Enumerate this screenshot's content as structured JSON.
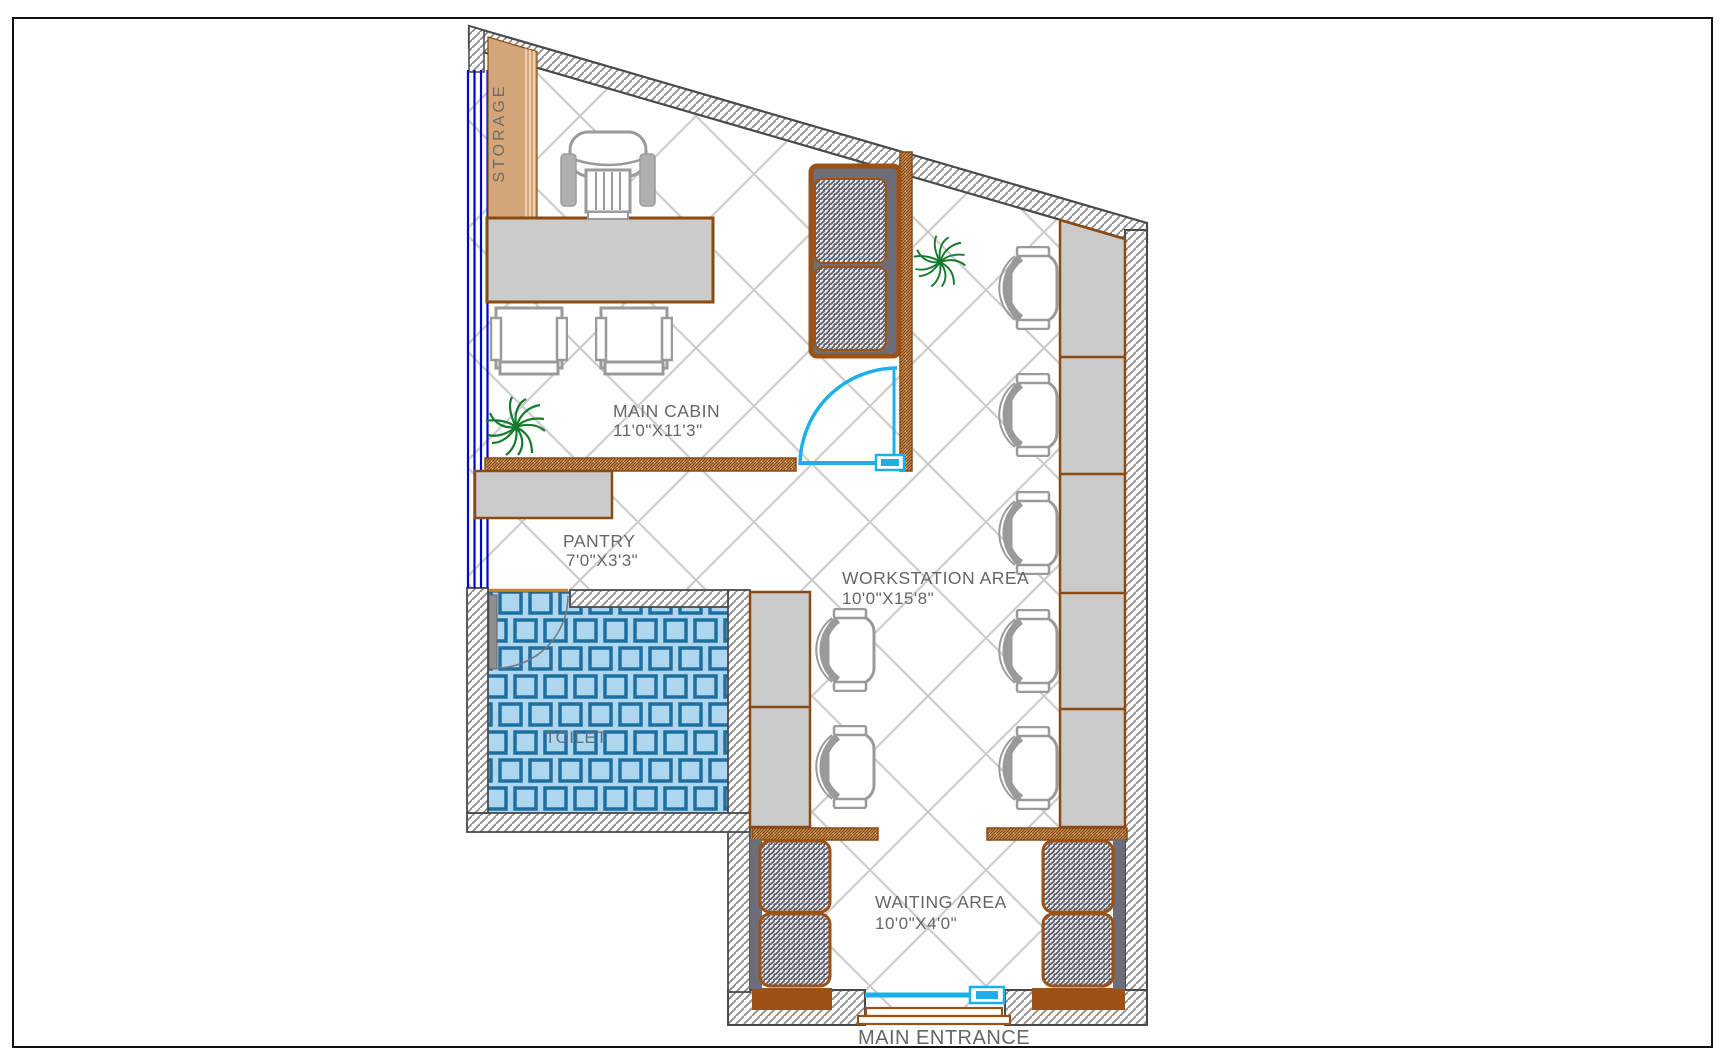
{
  "rooms": {
    "storage": {
      "label": "STORAGE"
    },
    "main_cabin": {
      "label": "MAIN CABIN",
      "dims": "11'0\"X11'3\""
    },
    "pantry": {
      "label": "PANTRY",
      "dims": "7'0\"X3'3\""
    },
    "toilet": {
      "label": "TOILET"
    },
    "workstation": {
      "label": "WORKSTATION AREA",
      "dims": "10'0\"X15'8\""
    },
    "waiting": {
      "label": "WAITING AREA",
      "dims": "10'0\"X4'0\""
    },
    "entrance": {
      "label": "MAIN ENTRANCE"
    }
  },
  "furniture_counts": {
    "workstation_desk_segments_right": 5,
    "workstation_desk_segments_left": 2,
    "workstation_chairs_right": 5,
    "workstation_chairs_left": 2,
    "guest_chairs_main_cabin": 2,
    "sofas": 3,
    "plants": 2
  },
  "colors": {
    "wall_outline": "#4a4a4a",
    "wall_hatch": "#8c8c8c",
    "partition_brown": "#8a4a12",
    "partition_tan": "#e2b98a",
    "solid_brown": "#9c5214",
    "desk_gray": "#cbcbcb",
    "sofa_texture_dark": "#5a5a64",
    "sofa_back_gray": "#6e6e7a",
    "door_cyan": "#1cb0e8",
    "window_blue": "#0008cc",
    "tile_fill": "#aed7ef",
    "tile_line": "#1e6f9f",
    "floor_grid": "#cccccc",
    "label_gray": "#666666",
    "plant_green": "#157a2e",
    "storage_tan": "#d2a679"
  }
}
